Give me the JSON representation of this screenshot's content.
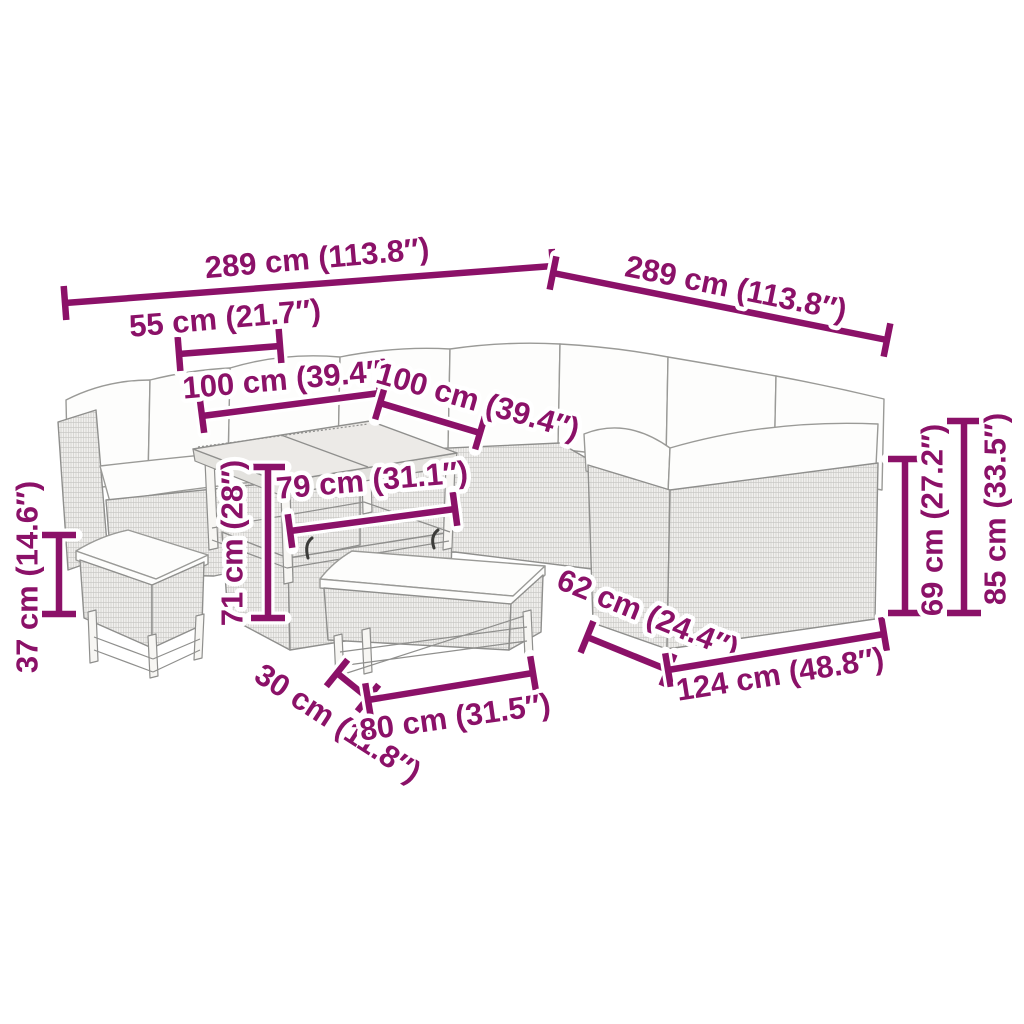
{
  "diagram": {
    "title": "rattan-lounge-set-dimension-diagram",
    "background": "#ffffff",
    "accent_color": "#8B1168",
    "halo_color": "#ffffff",
    "sketch_line_color": "#8f8f8d",
    "wicker_fill": "#f0efed",
    "cushion_fill": "#fdfdfc"
  },
  "dimensions": [
    {
      "id": "overall-width-left",
      "label": "289 cm (113.8″)",
      "line": {
        "x1": 65,
        "y1": 303,
        "x2": 553,
        "y2": 266
      },
      "text": {
        "x": 317,
        "y": 258,
        "rot": -5
      }
    },
    {
      "id": "overall-width-right",
      "label": "289 cm (113.8″)",
      "line": {
        "x1": 553,
        "y1": 273,
        "x2": 887,
        "y2": 340
      },
      "text": {
        "x": 736,
        "y": 288,
        "rot": 11.5
      }
    },
    {
      "id": "armrest-width-55",
      "label": "55 cm (21.7″)",
      "line": {
        "x1": 179,
        "y1": 354,
        "x2": 280,
        "y2": 346
      },
      "text": {
        "x": 225,
        "y": 318,
        "rot": -5
      }
    },
    {
      "id": "section-width-100-left",
      "label": "100 cm (39.4″)",
      "line": {
        "x1": 202,
        "y1": 416,
        "x2": 380,
        "y2": 393
      },
      "text": {
        "x": 287,
        "y": 379,
        "rot": -5
      }
    },
    {
      "id": "section-width-100-right",
      "label": "100 cm (39.4″)",
      "line": {
        "x1": 380,
        "y1": 403,
        "x2": 480,
        "y2": 433
      },
      "text": {
        "x": 478,
        "y": 401,
        "rot": 16
      }
    },
    {
      "id": "table-width-79",
      "label": "79 cm (31.1″)",
      "line": {
        "x1": 290,
        "y1": 531,
        "x2": 455,
        "y2": 509
      },
      "text": {
        "x": 372,
        "y": 480,
        "rot": -5
      }
    },
    {
      "id": "table-height-71",
      "label": "71 cm (28″)",
      "line": {
        "x1": 268,
        "y1": 467,
        "x2": 268,
        "y2": 618
      },
      "text": {
        "x": 232,
        "y": 543,
        "rot": -90
      }
    },
    {
      "id": "bench-height-37",
      "label": "37 cm (14.6″)",
      "line": {
        "x1": 59,
        "y1": 535,
        "x2": 59,
        "y2": 614
      },
      "text": {
        "x": 27,
        "y": 577,
        "rot": -90
      }
    },
    {
      "id": "bench-depth-30",
      "label": "30 cm (11.8″)",
      "line": {
        "x1": 337,
        "y1": 673,
        "x2": 368,
        "y2": 698
      },
      "text": {
        "x": 338,
        "y": 723,
        "rot": 33
      }
    },
    {
      "id": "bench-width-80",
      "label": "80 cm (31.5″)",
      "line": {
        "x1": 368,
        "y1": 700,
        "x2": 533,
        "y2": 673
      },
      "text": {
        "x": 455,
        "y": 717,
        "rot": -8
      }
    },
    {
      "id": "sofa-depth-62",
      "label": "62 cm (24.4″)",
      "line": {
        "x1": 587,
        "y1": 637,
        "x2": 668,
        "y2": 670
      },
      "text": {
        "x": 648,
        "y": 614,
        "rot": 22
      }
    },
    {
      "id": "sofa-width-124",
      "label": "124 cm (48.8″)",
      "line": {
        "x1": 668,
        "y1": 670,
        "x2": 884,
        "y2": 634
      },
      "text": {
        "x": 780,
        "y": 674,
        "rot": -9
      }
    },
    {
      "id": "seat-back-height-69",
      "label": "69 cm (27.2″)",
      "line": {
        "x1": 905,
        "y1": 459,
        "x2": 905,
        "y2": 613
      },
      "text": {
        "x": 932,
        "y": 520,
        "rot": -90
      }
    },
    {
      "id": "total-height-85",
      "label": "85 cm (33.5″)",
      "line": {
        "x1": 964,
        "y1": 421,
        "x2": 964,
        "y2": 613
      },
      "text": {
        "x": 995,
        "y": 509,
        "rot": -90
      }
    }
  ]
}
